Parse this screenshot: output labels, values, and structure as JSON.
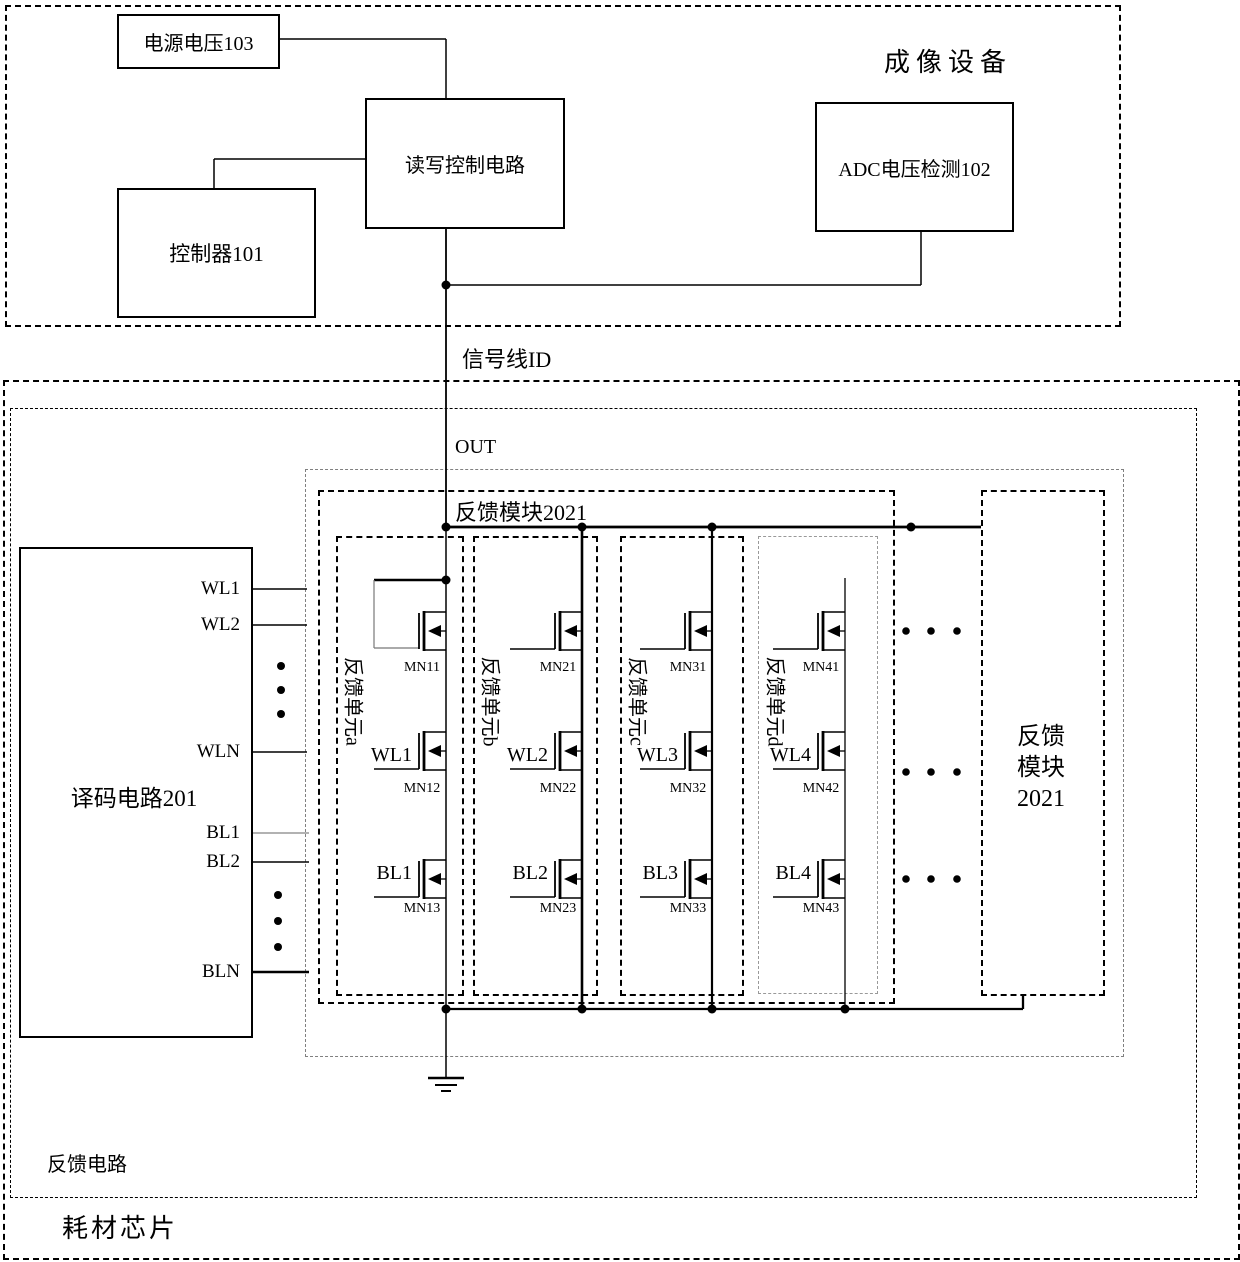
{
  "imaging_device": {
    "title": "成像设备",
    "power_box": "电源电压103",
    "rw_control_box": "读写控制电路",
    "controller_box": "控制器101",
    "adc_box": "ADC电压检测102"
  },
  "signal_line_label": "信号线ID",
  "out_label": "OUT",
  "consumable_chip": {
    "label": "耗材芯片"
  },
  "feedback_circuit": {
    "label": "反馈电路"
  },
  "decoder": {
    "title": "译码电路201",
    "ports": [
      "WL1",
      "WL2",
      "WLN",
      "BL1",
      "BL2",
      "BLN"
    ]
  },
  "feedback_module": {
    "title": "反馈模块2021",
    "units": [
      {
        "name": "反馈单元a",
        "t1": "MN11",
        "t2": "MN12",
        "t3": "MN13",
        "wl": "WL1",
        "bl": "BL1"
      },
      {
        "name": "反馈单元b",
        "t1": "MN21",
        "t2": "MN22",
        "t3": "MN23",
        "wl": "WL2",
        "bl": "BL2"
      },
      {
        "name": "反馈单元c",
        "t1": "MN31",
        "t2": "MN32",
        "t3": "MN33",
        "wl": "WL3",
        "bl": "BL3"
      },
      {
        "name": "反馈单元d",
        "t1": "MN41",
        "t2": "MN42",
        "t3": "MN43",
        "wl": "WL4",
        "bl": "BL4"
      }
    ]
  },
  "feedback_module_right": {
    "line1": "反馈",
    "line2": "模块",
    "line3": "2021"
  },
  "colors": {
    "line": "#000000",
    "light_line": "#777777",
    "gray_dash": "#808080"
  }
}
